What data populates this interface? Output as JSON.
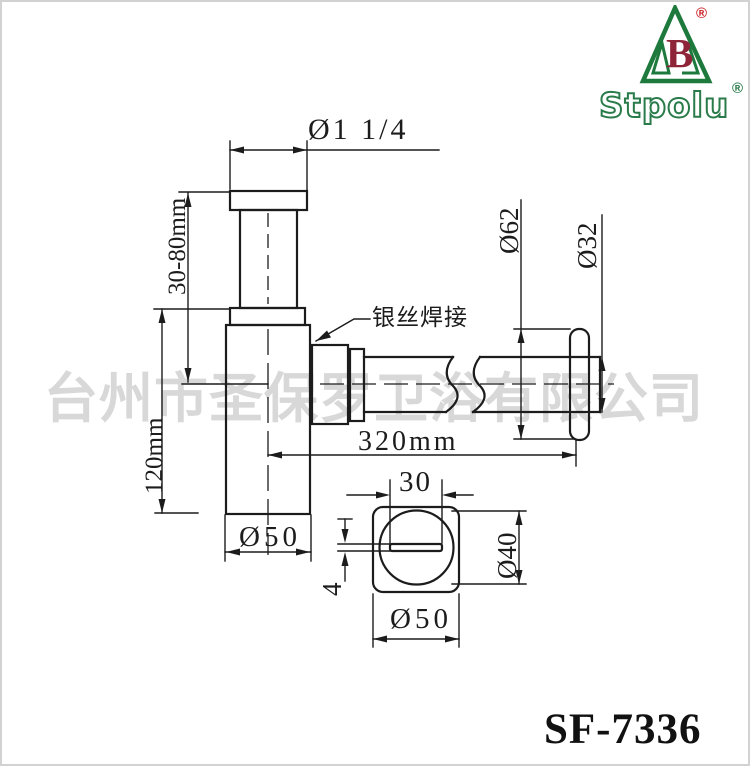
{
  "brand": {
    "name": "Stpolu",
    "logo_letter": "B",
    "registered_mark": "®"
  },
  "watermark": "台州市圣保罗卫浴有限公司",
  "model": "SF-7336",
  "labels": {
    "top_diameter": "Ø1 1/4",
    "adjustable_height": "30-80mm",
    "body_height": "120mm",
    "weld_note": "银丝焊接",
    "pipe_length": "320mm",
    "flange_diameter": "Ø62",
    "pipe_diameter": "Ø32",
    "body_diameter": "Ø50",
    "slot_length": "30",
    "circle_diameter": "Ø40",
    "slot_width": "4",
    "base_diameter": "Ø50"
  },
  "colors": {
    "line": "#1c1c1c",
    "brand_green": "#1e7a3c",
    "logo_red": "#8e2438",
    "registered_red": "#cc2327",
    "watermark_gray": "#d8d8d8"
  }
}
